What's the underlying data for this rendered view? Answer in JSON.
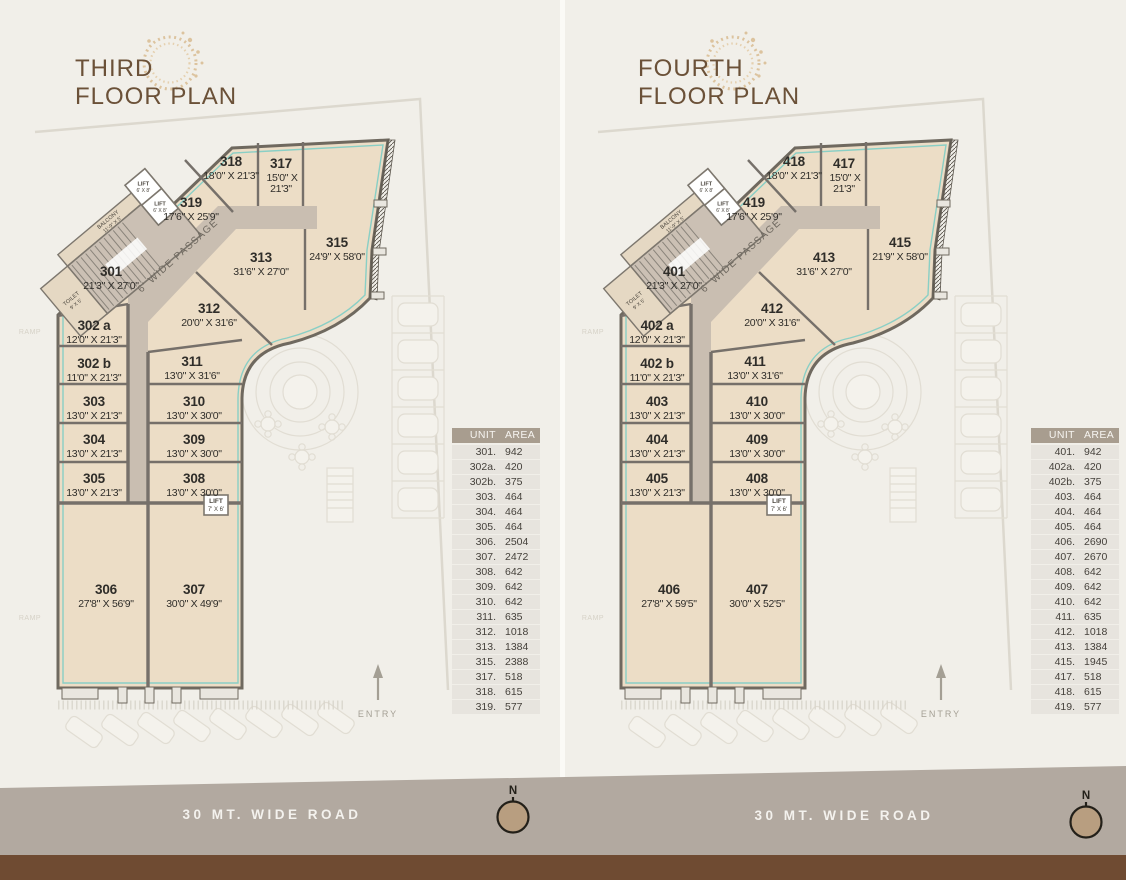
{
  "colors": {
    "page_background": "#f1efe9",
    "unit_fill": "#ecddc6",
    "wall": "#6f695f",
    "teal_outline": "#84cdc5",
    "passage_fill": "#c9beb1",
    "title_brown": "#6b5138",
    "logo_tan": "#d9bc92",
    "table_header_bg": "#a89d8f",
    "table_row_bg": "#e7e4de",
    "road_band": "#b2a9a0",
    "bottom_band": "#6f4b32",
    "road_text": "#f4f2ee",
    "compass_fill": "#b89e80",
    "entry_gray": "#a49f94"
  },
  "plans": [
    {
      "title_line1": "THIRD",
      "title_line2": "FLOOR PLAN",
      "road_label": "30 MT. WIDE ROAD",
      "compass_label": "N",
      "entry_label": "ENTRY",
      "passage_label": "6' WIDE PASSAGE",
      "ramp_label": "RAMP",
      "toilet_line1": "TOILET",
      "toilet_line2": "9' X 5'",
      "balcony_line1": "BALCONY",
      "balcony_line2": "11'-9\" X 5'",
      "lift_large_line1": "LIFT",
      "lift_large_line2": "6' X 8'",
      "lift_small_line1": "LIFT",
      "lift_small_line2": "7' X 6'",
      "units": [
        {
          "number": "301",
          "dims": "21'3\" X 27'0\""
        },
        {
          "number": "302 a",
          "dims": "12'0\" X 21'3\""
        },
        {
          "number": "302 b",
          "dims": "11'0\" X 21'3\""
        },
        {
          "number": "303",
          "dims": "13'0\" X 21'3\""
        },
        {
          "number": "304",
          "dims": "13'0\" X 21'3\""
        },
        {
          "number": "305",
          "dims": "13'0\" X 21'3\""
        },
        {
          "number": "306",
          "dims": "27'8\" X 56'9\""
        },
        {
          "number": "307",
          "dims": "30'0\" X 49'9\""
        },
        {
          "number": "308",
          "dims": "13'0\" X 30'0\""
        },
        {
          "number": "309",
          "dims": "13'0\" X 30'0\""
        },
        {
          "number": "310",
          "dims": "13'0\" X 30'0\""
        },
        {
          "number": "311",
          "dims": "13'0\" X 31'6\""
        },
        {
          "number": "312",
          "dims": "20'0\" X 31'6\""
        },
        {
          "number": "313",
          "dims": "31'6\" X 27'0\""
        },
        {
          "number": "315",
          "dims": "24'9\" X 58'0\""
        },
        {
          "number": "317",
          "dims_line1": "15'0\" X",
          "dims_line2": "21'3\""
        },
        {
          "number": "318",
          "dims": "18'0\" X 21'3\""
        },
        {
          "number": "319",
          "dims": "17'6\" X 25'9\""
        }
      ],
      "table": {
        "headers": [
          "UNIT",
          "AREA"
        ],
        "rows": [
          [
            "301.",
            "942"
          ],
          [
            "302a.",
            "420"
          ],
          [
            "302b.",
            "375"
          ],
          [
            "303.",
            "464"
          ],
          [
            "304.",
            "464"
          ],
          [
            "305.",
            "464"
          ],
          [
            "306.",
            "2504"
          ],
          [
            "307.",
            "2472"
          ],
          [
            "308.",
            "642"
          ],
          [
            "309.",
            "642"
          ],
          [
            "310.",
            "642"
          ],
          [
            "311.",
            "635"
          ],
          [
            "312.",
            "1018"
          ],
          [
            "313.",
            "1384"
          ],
          [
            "315.",
            "2388"
          ],
          [
            "317.",
            "518"
          ],
          [
            "318.",
            "615"
          ],
          [
            "319.",
            "577"
          ]
        ]
      }
    },
    {
      "title_line1": "FOURTH",
      "title_line2": "FLOOR PLAN",
      "road_label": "30 MT. WIDE ROAD",
      "compass_label": "N",
      "entry_label": "ENTRY",
      "passage_label": "6' WIDE PASSAGE",
      "ramp_label": "RAMP",
      "toilet_line1": "TOILET",
      "toilet_line2": "9' X 5'",
      "balcony_line1": "BALCONY",
      "balcony_line2": "11'-9\" X 5'",
      "lift_large_line1": "LIFT",
      "lift_large_line2": "6' X 8'",
      "lift_small_line1": "LIFT",
      "lift_small_line2": "7' X 6'",
      "units": [
        {
          "number": "401",
          "dims": "21'3\" X 27'0\""
        },
        {
          "number": "402 a",
          "dims": "12'0\" X 21'3\""
        },
        {
          "number": "402 b",
          "dims": "11'0\" X 21'3\""
        },
        {
          "number": "403",
          "dims": "13'0\" X 21'3\""
        },
        {
          "number": "404",
          "dims": "13'0\" X 21'3\""
        },
        {
          "number": "405",
          "dims": "13'0\" X 21'3\""
        },
        {
          "number": "406",
          "dims": "27'8\" X 59'5\""
        },
        {
          "number": "407",
          "dims": "30'0\" X 52'5\""
        },
        {
          "number": "408",
          "dims": "13'0\" X 30'0\""
        },
        {
          "number": "409",
          "dims": "13'0\" X 30'0\""
        },
        {
          "number": "410",
          "dims": "13'0\" X 30'0\""
        },
        {
          "number": "411",
          "dims": "13'0\" X 31'6\""
        },
        {
          "number": "412",
          "dims": "20'0\" X 31'6\""
        },
        {
          "number": "413",
          "dims": "31'6\" X 27'0\""
        },
        {
          "number": "415",
          "dims": "21'9\" X 58'0\""
        },
        {
          "number": "417",
          "dims_line1": "15'0\" X",
          "dims_line2": "21'3\""
        },
        {
          "number": "418",
          "dims": "18'0\" X 21'3\""
        },
        {
          "number": "419",
          "dims": "17'6\" X 25'9\""
        }
      ],
      "table": {
        "headers": [
          "UNIT",
          "AREA"
        ],
        "rows": [
          [
            "401.",
            "942"
          ],
          [
            "402a.",
            "420"
          ],
          [
            "402b.",
            "375"
          ],
          [
            "403.",
            "464"
          ],
          [
            "404.",
            "464"
          ],
          [
            "405.",
            "464"
          ],
          [
            "406.",
            "2690"
          ],
          [
            "407.",
            "2670"
          ],
          [
            "408.",
            "642"
          ],
          [
            "409.",
            "642"
          ],
          [
            "410.",
            "642"
          ],
          [
            "411.",
            "635"
          ],
          [
            "412.",
            "1018"
          ],
          [
            "413.",
            "1384"
          ],
          [
            "415.",
            "1945"
          ],
          [
            "417.",
            "518"
          ],
          [
            "418.",
            "615"
          ],
          [
            "419.",
            "577"
          ]
        ]
      }
    }
  ]
}
